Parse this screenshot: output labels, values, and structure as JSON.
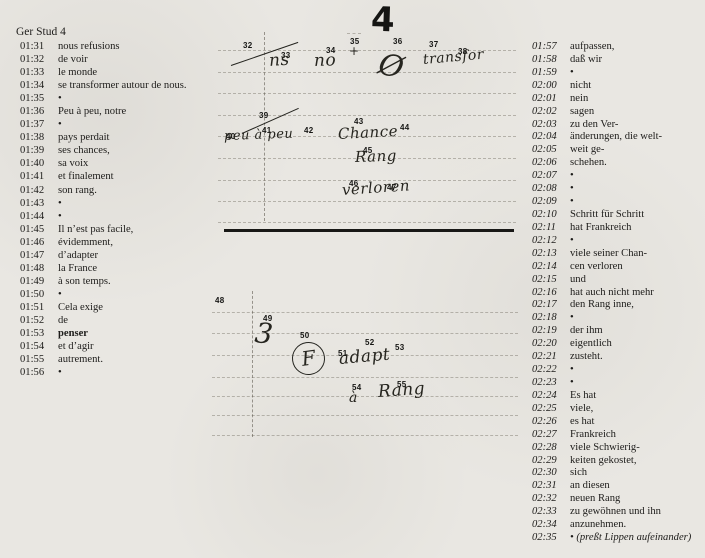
{
  "header": {
    "title": "Ger Stud 4"
  },
  "colors": {
    "paper": "#e9e7e2",
    "ink": "#1d1c1a",
    "rule": "#6e685e",
    "divider": "#181816"
  },
  "left_column": {
    "rows": [
      {
        "time": "01:31",
        "text": "nous refusions"
      },
      {
        "time": "01:32",
        "text": "de voir"
      },
      {
        "time": "01:33",
        "text": "le monde"
      },
      {
        "time": "01:34",
        "text": "se transformer autour de nous."
      },
      {
        "time": "01:35",
        "text": "•"
      },
      {
        "time": "01:36",
        "text": "Peu à peu, notre"
      },
      {
        "time": "01:37",
        "text": "•"
      },
      {
        "time": "01:38",
        "text": "pays perdait"
      },
      {
        "time": "01:39",
        "text": "ses chances,"
      },
      {
        "time": "01:40",
        "text": "sa voix"
      },
      {
        "time": "01:41",
        "text": "et finalement"
      },
      {
        "time": "01:42",
        "text": "son rang."
      },
      {
        "time": "01:43",
        "text": "•"
      },
      {
        "time": "01:44",
        "text": "•"
      },
      {
        "time": "01:45",
        "text": "Il n’est pas facile,"
      },
      {
        "time": "01:46",
        "text": "évidemment,"
      },
      {
        "time": "01:47",
        "text": "d’adapter"
      },
      {
        "time": "01:48",
        "text": "la France"
      },
      {
        "time": "01:49",
        "text": "à son temps."
      },
      {
        "time": "01:50",
        "text": "•"
      },
      {
        "time": "01:51",
        "text": "Cela exige"
      },
      {
        "time": "01:52",
        "text": "de"
      },
      {
        "time": "01:53",
        "text": "penser",
        "bold": true
      },
      {
        "time": "01:54",
        "text": "et d’agir"
      },
      {
        "time": "01:55",
        "text": "autrement."
      },
      {
        "time": "01:56",
        "text": "•"
      }
    ]
  },
  "right_column": {
    "rows": [
      {
        "time": "01:57",
        "text": "aufpassen,"
      },
      {
        "time": "01:58",
        "text": "daß wir"
      },
      {
        "time": "01:59",
        "text": "•"
      },
      {
        "time": "02:00",
        "text": "nicht"
      },
      {
        "time": "02:01",
        "text": "nein"
      },
      {
        "time": "02:02",
        "text": "sagen"
      },
      {
        "time": "02:03",
        "text": "zu den Ver-"
      },
      {
        "time": "02:04",
        "text": "änderungen, die welt-"
      },
      {
        "time": "02:05",
        "text": "weit ge-"
      },
      {
        "time": "02:06",
        "text": "schehen."
      },
      {
        "time": "02:07",
        "text": "•"
      },
      {
        "time": "02:08",
        "text": "•"
      },
      {
        "time": "02:09",
        "text": "•"
      },
      {
        "time": "02:10",
        "text": "Schritt für Schritt"
      },
      {
        "time": "02:11",
        "text": "hat Frankreich"
      },
      {
        "time": "02:12",
        "text": "•"
      },
      {
        "time": "02:13",
        "text": "viele seiner Chan-"
      },
      {
        "time": "02:14",
        "text": "cen verloren"
      },
      {
        "time": "02:15",
        "text": "und"
      },
      {
        "time": "02:16",
        "text": "hat auch nicht mehr"
      },
      {
        "time": "02:17",
        "text": "den Rang inne,"
      },
      {
        "time": "02:18",
        "text": "•"
      },
      {
        "time": "02:19",
        "text": "der ihm"
      },
      {
        "time": "02:20",
        "text": "eigentlich"
      },
      {
        "time": "02:21",
        "text": "zusteht."
      },
      {
        "time": "02:22",
        "text": "•"
      },
      {
        "time": "02:23",
        "text": "•"
      },
      {
        "time": "02:24",
        "text": "Es hat"
      },
      {
        "time": "02:25",
        "text": "viele,"
      },
      {
        "time": "02:26",
        "text": "es hat"
      },
      {
        "time": "02:27",
        "text": "Frankreich"
      },
      {
        "time": "02:28",
        "text": "viele Schwierig-"
      },
      {
        "time": "02:29",
        "text": "keiten gekostet,"
      },
      {
        "time": "02:30",
        "text": "sich"
      },
      {
        "time": "02:31",
        "text": "an diesen"
      },
      {
        "time": "02:32",
        "text": "neuen Rang"
      },
      {
        "time": "02:33",
        "text": "zu gewöhnen und ihn"
      },
      {
        "time": "02:34",
        "text": "anzunehmen."
      },
      {
        "time": "02:35",
        "text": "• (preßt Lippen aufeinander)",
        "italic": true
      }
    ]
  },
  "annotations": {
    "page_number": "4",
    "markers": [
      {
        "n": "32",
        "x": 243,
        "y": 41
      },
      {
        "n": "33",
        "x": 281,
        "y": 51
      },
      {
        "n": "34",
        "x": 326,
        "y": 46
      },
      {
        "n": "35",
        "x": 350,
        "y": 37
      },
      {
        "n": "36",
        "x": 393,
        "y": 37
      },
      {
        "n": "37",
        "x": 429,
        "y": 40
      },
      {
        "n": "38",
        "x": 458,
        "y": 47
      },
      {
        "n": "39",
        "x": 259,
        "y": 111
      },
      {
        "n": "40",
        "x": 226,
        "y": 132
      },
      {
        "n": "41",
        "x": 262,
        "y": 126
      },
      {
        "n": "42",
        "x": 304,
        "y": 126
      },
      {
        "n": "43",
        "x": 354,
        "y": 117
      },
      {
        "n": "44",
        "x": 400,
        "y": 123
      },
      {
        "n": "45",
        "x": 363,
        "y": 146
      },
      {
        "n": "46",
        "x": 349,
        "y": 179
      },
      {
        "n": "47",
        "x": 387,
        "y": 183
      },
      {
        "n": "48",
        "x": 215,
        "y": 296
      },
      {
        "n": "49",
        "x": 263,
        "y": 314
      },
      {
        "n": "50",
        "x": 300,
        "y": 331
      },
      {
        "n": "51",
        "x": 338,
        "y": 349
      },
      {
        "n": "52",
        "x": 365,
        "y": 338
      },
      {
        "n": "53",
        "x": 395,
        "y": 343
      },
      {
        "n": "54",
        "x": 352,
        "y": 383
      },
      {
        "n": "55",
        "x": 397,
        "y": 380
      }
    ],
    "handwriting": [
      {
        "text": "ns",
        "x": 269,
        "y": 51,
        "size": 17,
        "rot": -4
      },
      {
        "text": "no",
        "x": 314,
        "y": 51,
        "size": 17,
        "rot": -2
      },
      {
        "text": "+",
        "x": 349,
        "y": 44,
        "size": 12,
        "rot": 0
      },
      {
        "text": "Ø",
        "x": 379,
        "y": 46,
        "size": 30,
        "rot": 14
      },
      {
        "text": "transfor",
        "x": 423,
        "y": 52,
        "size": 14,
        "rot": -5
      },
      {
        "text": "peu à peu",
        "x": 224,
        "y": 129,
        "size": 13,
        "rot": -2
      },
      {
        "text": "Chance",
        "x": 338,
        "y": 125,
        "size": 15,
        "rot": -3
      },
      {
        "text": "Rang",
        "x": 355,
        "y": 148,
        "size": 15,
        "rot": -2
      },
      {
        "text": "verloren",
        "x": 342,
        "y": 181,
        "size": 15,
        "rot": -4
      },
      {
        "text": "3",
        "x": 255,
        "y": 316,
        "size": 28,
        "rot": 6
      },
      {
        "text": "adapt",
        "x": 339,
        "y": 349,
        "size": 17,
        "rot": -5
      },
      {
        "text": "à",
        "x": 349,
        "y": 390,
        "size": 14,
        "rot": 0
      },
      {
        "text": "Rang",
        "x": 378,
        "y": 382,
        "size": 17,
        "rot": -4
      }
    ],
    "circled": [
      {
        "text": "F",
        "x": 292,
        "y": 342,
        "d": 33
      }
    ],
    "strokes": [
      {
        "x": 231,
        "y": 65,
        "w": 71,
        "rot": -19
      },
      {
        "x": 242,
        "y": 133,
        "w": 62,
        "rot": -24
      }
    ],
    "divider": {
      "x": 224,
      "y": 229,
      "w": 290
    },
    "vlines": [
      {
        "x": 264,
        "y": 32,
        "h": 189
      },
      {
        "x": 252,
        "y": 291,
        "h": 146
      }
    ],
    "hlines": [
      {
        "x": 347,
        "y": 33,
        "w": 14
      },
      {
        "x": 218,
        "y": 50,
        "w": 298
      },
      {
        "x": 218,
        "y": 72,
        "w": 298
      },
      {
        "x": 218,
        "y": 93,
        "w": 298
      },
      {
        "x": 218,
        "y": 115,
        "w": 298
      },
      {
        "x": 218,
        "y": 136,
        "w": 298
      },
      {
        "x": 218,
        "y": 158,
        "w": 298
      },
      {
        "x": 218,
        "y": 180,
        "w": 298
      },
      {
        "x": 218,
        "y": 201,
        "w": 298
      },
      {
        "x": 218,
        "y": 222,
        "w": 298
      },
      {
        "x": 212,
        "y": 312,
        "w": 306
      },
      {
        "x": 212,
        "y": 333,
        "w": 306
      },
      {
        "x": 212,
        "y": 355,
        "w": 306
      },
      {
        "x": 212,
        "y": 377,
        "w": 306
      },
      {
        "x": 212,
        "y": 396,
        "w": 306
      },
      {
        "x": 212,
        "y": 415,
        "w": 306
      },
      {
        "x": 212,
        "y": 435,
        "w": 306
      }
    ]
  }
}
